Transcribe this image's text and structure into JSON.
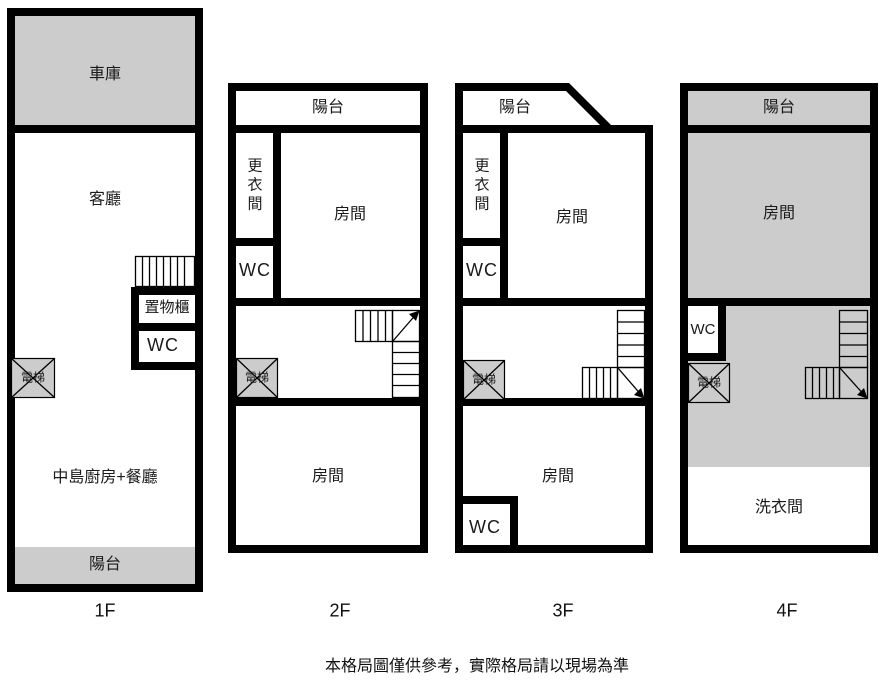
{
  "title": "floor-plan",
  "colors": {
    "wall": "#000000",
    "shaded": "#cccccc",
    "background": "#ffffff"
  },
  "floors": [
    {
      "label": "1F",
      "rooms": {
        "garage": "車庫",
        "living": "客廳",
        "cabinet": "置物櫃",
        "wc": "WC",
        "elevator": "電梯",
        "kitchen": "中島廚房+餐廳",
        "balcony": "陽台"
      }
    },
    {
      "label": "2F",
      "rooms": {
        "balcony": "陽台",
        "dressing": "更衣間",
        "wc": "WC",
        "room_upper": "房間",
        "elevator": "電梯",
        "room_lower": "房間"
      }
    },
    {
      "label": "3F",
      "rooms": {
        "balcony": "陽台",
        "dressing": "更衣間",
        "wc_upper": "WC",
        "room_upper": "房間",
        "elevator": "電梯",
        "room_lower": "房間",
        "wc_lower": "WC"
      }
    },
    {
      "label": "4F",
      "rooms": {
        "balcony": "陽台",
        "room": "房間",
        "wc": "WC",
        "elevator": "電梯",
        "laundry": "洗衣間"
      }
    }
  ],
  "footer": {
    "disclaimer": "本格局圖僅供參考，實際格局請以現場為準"
  }
}
